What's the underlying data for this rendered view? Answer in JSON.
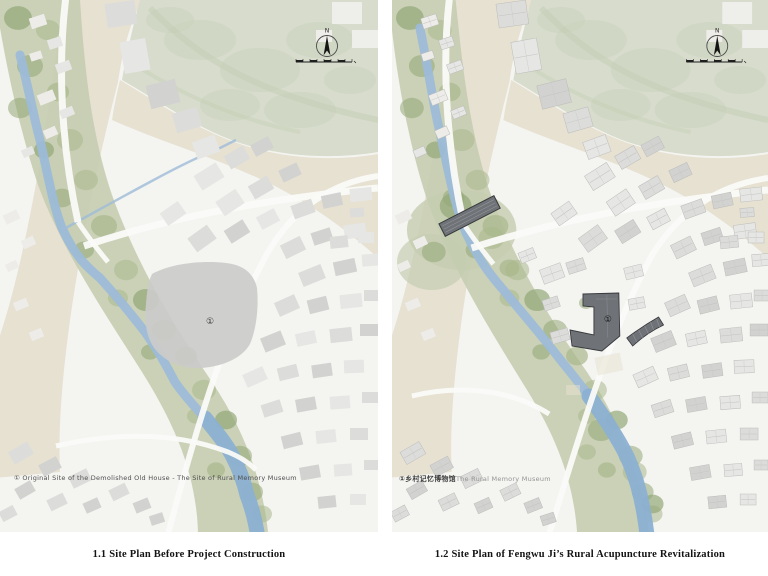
{
  "figure": {
    "type": "architectural-site-plans",
    "panel_count": 2
  },
  "panels": [
    {
      "id": "before",
      "caption": "1.1 Site Plan Before Project Construction",
      "legend": {
        "marker": "①",
        "text": "Original Site of the Demolished Old House - The Site of Rural Memory Museum"
      },
      "map_marker": "①",
      "compass_label": "N"
    },
    {
      "id": "after",
      "caption": "1.2 Site Plan of Fengwu Ji’s Rural Acupuncture Revitalization",
      "legend": {
        "marker": "①",
        "text_zh": "乡村记忆博物馆",
        "text_en": "The Rural Memory Museum"
      },
      "map_marker": "①",
      "compass_label": "N"
    }
  ],
  "colors": {
    "mapbg": "#f4f4f1",
    "hill": "#d7dccc",
    "hillmottle": "#c9d2bb",
    "sand": "#e7e1d2",
    "corridor": "#c5cdb0",
    "treea": "#a9b88c",
    "treeb": "#93a877",
    "river": "#9dbbd8",
    "riverdeep": "#8bb0d2",
    "building_light": "#e6e6e4",
    "building_mid": "#dcdcda",
    "building_dark_gray": "#d2d2d0",
    "road": "#fafaf8",
    "new_building": "#6f7276",
    "new_building_outline": "#37393c",
    "demolished_site": "#cbcbca",
    "caption_ink": "#141414",
    "legend_text": "#4f4f4f",
    "legend_muted": "#949494"
  }
}
